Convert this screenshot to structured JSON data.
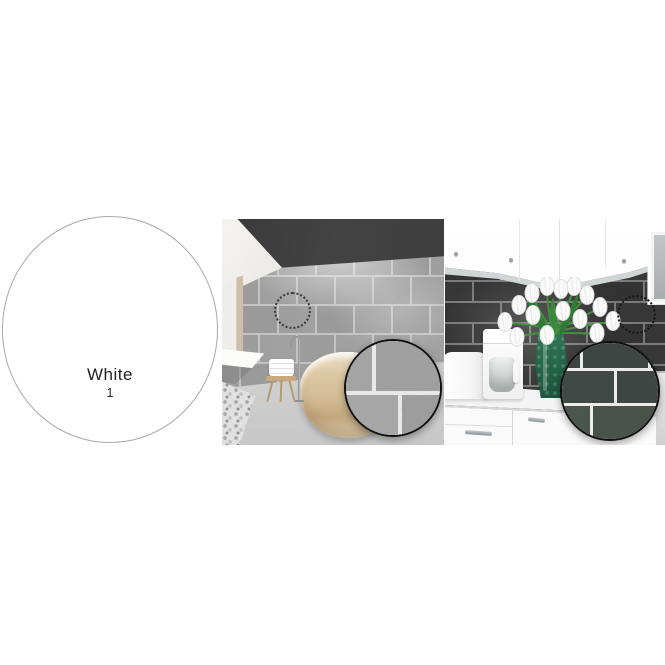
{
  "swatch": {
    "color_name": "White",
    "color_number": "1"
  },
  "colors": {
    "canvas_bg": "#ffffff",
    "swatch_fill": "#ffffff",
    "swatch_border": "#a8a8a8",
    "label_text": "#222222",
    "bath_tile": "#9d9d9d",
    "bath_grout": "#c6c6c6",
    "bath_ceiling": "#434343",
    "bath_floor": "#d9d9d9",
    "tub_wood": "#d2bb94",
    "kitchen_tile": "#333333",
    "kitchen_grout": "#7a7a7a",
    "cabinet": "#fbfbfb",
    "counter": "#f2f3f3",
    "vase_green": "#2a6f50",
    "magnifier_border": "#101010",
    "mag_bath_tile": "#a3a3a3",
    "mag_bath_grout": "#f2f2f2",
    "mag_kitchen_tile": "#3e4743",
    "mag_kitchen_grout": "#efefef"
  }
}
